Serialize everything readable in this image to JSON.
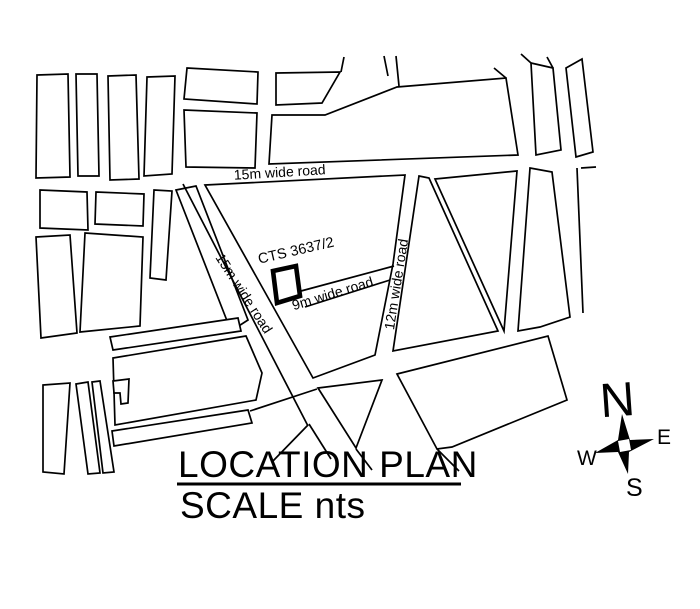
{
  "page": {
    "background": "#ffffff",
    "ink": "#000000"
  },
  "title_block": {
    "title": "LOCATION PLAN",
    "scale_label": "SCALE nts"
  },
  "compass": {
    "north": "N",
    "east": "E",
    "west": "W",
    "south": "S"
  },
  "plot": {
    "label": "CTS 3637/2",
    "points": "273,271 296,266 300,296 277,303"
  },
  "map": {
    "stroke": "#000000",
    "blocks": [
      {
        "points": "37,75 68,74 70,177 36,178"
      },
      {
        "points": "76,74 97,74 99,176 78,176"
      },
      {
        "points": "108,76 136,75 139,179 110,180"
      },
      {
        "points": "147,77 175,76 172,174 144,176"
      },
      {
        "points": "187,68 258,72 257,104 184,99"
      },
      {
        "points": "184,110 257,113 255,168 186,167"
      },
      {
        "points": "276,73 340,72 322,103 276,105"
      },
      {
        "points": "272,115 325,115 397,87 506,78 518,155 269,164"
      },
      {
        "points": "531,63 553,68 561,150 536,155"
      },
      {
        "points": "566,68 582,59 593,152 576,157"
      },
      {
        "points": "40,190 87,192 88,230 40,228"
      },
      {
        "points": "96,192 144,194 143,226 95,224"
      },
      {
        "points": "36,237 70,235 77,333 41,338"
      },
      {
        "points": "85,233 143,237 140,326 80,332"
      },
      {
        "points": "154,190 172,191 166,280 150,278"
      },
      {
        "points": "176,190 196,186 248,320 231,331"
      },
      {
        "points": "110,337 238,318 241,331 113,350"
      },
      {
        "points": "113,358 246,336 262,373 256,400 115,425"
      },
      {
        "points": "112,431 248,410 252,423 114,446"
      },
      {
        "points": "43,385 70,383 64,474 43,472"
      },
      {
        "points": "76,384 88,382 100,473 88,474"
      },
      {
        "points": "92,382 100,381 114,472 103,473"
      },
      {
        "points": "113,381 129,379 128,403 121,404 120,393 114,393"
      },
      {
        "points": "205,185 405,175 393,264 375,355 313,378"
      },
      {
        "points": "318,388 382,380 356,448"
      },
      {
        "points": "419,176 429,178 498,331 393,351"
      },
      {
        "points": "435,179 517,171 504,331"
      },
      {
        "points": "530,168 552,172 570,317 540,327 518,331"
      },
      {
        "points": "397,374 548,336 567,400 452,447 437,449"
      }
    ],
    "lines": [
      [
        341,
        72,
        344,
        57
      ],
      [
        384,
        56,
        388,
        76
      ],
      [
        396,
        56,
        399,
        86
      ],
      [
        506,
        78,
        494,
        68
      ],
      [
        531,
        63,
        521,
        54
      ],
      [
        553,
        68,
        547,
        57
      ],
      [
        577,
        168,
        583,
        313
      ],
      [
        581,
        168,
        596,
        167
      ],
      [
        183,
        184,
        308,
        426
      ],
      [
        301,
        291,
        394,
        266
      ],
      [
        305,
        307,
        390,
        280
      ],
      [
        250,
        411,
        317,
        389
      ],
      [
        309,
        424,
        331,
        459
      ],
      [
        272,
        462,
        308,
        425
      ],
      [
        356,
        449,
        372,
        470
      ],
      [
        437,
        449,
        459,
        471
      ]
    ],
    "road_labels": [
      {
        "text": "15m wide road",
        "x": 280,
        "y": 177,
        "rotate": -3.5,
        "size": 14
      },
      {
        "text": "15m wide road",
        "x": 240,
        "y": 296,
        "rotate": 57,
        "size": 14
      },
      {
        "text": "9m wide road",
        "x": 334,
        "y": 298,
        "rotate": -17,
        "size": 14
      },
      {
        "text": "12m wide road",
        "x": 401,
        "y": 285,
        "rotate": -81,
        "size": 14
      },
      {
        "text": "CTS 3637/2",
        "x": 297,
        "y": 255,
        "rotate": -13,
        "size": 14.5
      }
    ]
  }
}
